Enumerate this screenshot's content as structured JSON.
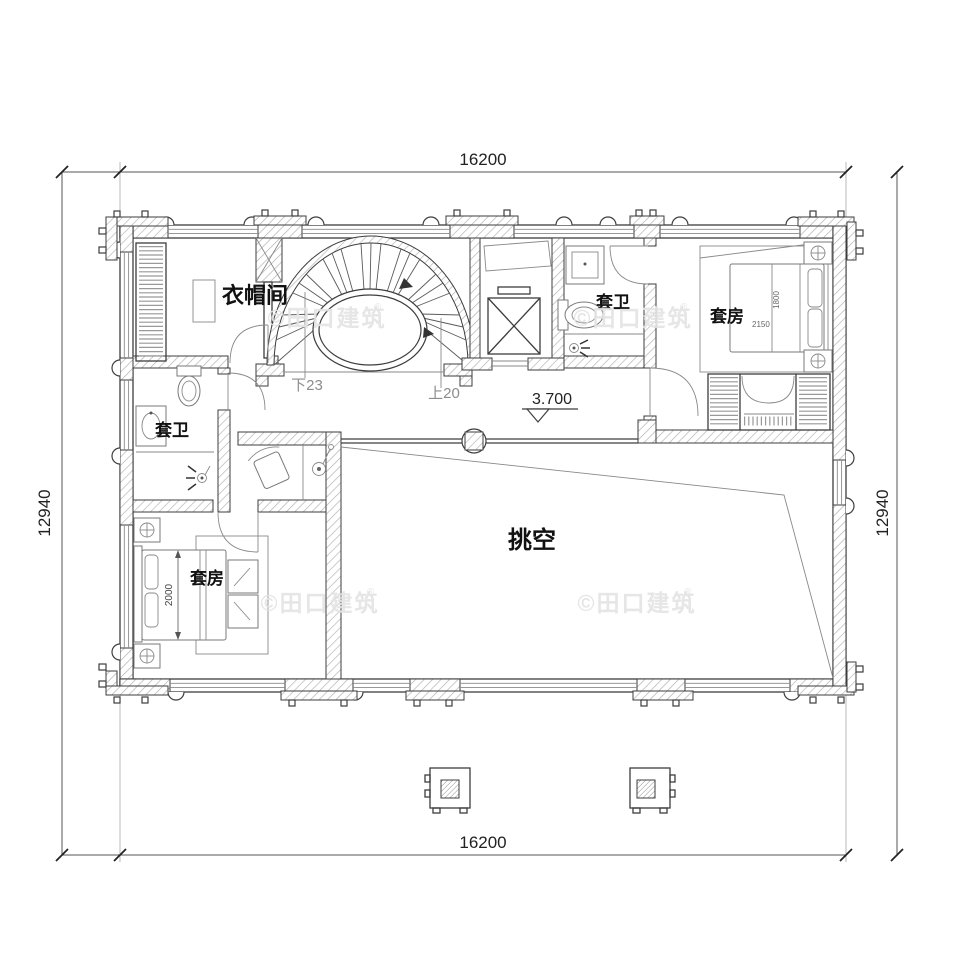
{
  "dimensions": {
    "top": "16200",
    "bottom": "16200",
    "left": "12940",
    "right": "12940",
    "bed_left": "2000",
    "bed_right_width": "1800",
    "bed_right_length": "2150"
  },
  "rooms": {
    "cloakroom": "衣帽间",
    "bath_top": "套卫",
    "bath_left": "套卫",
    "suite_right": "套房",
    "suite_left": "套房",
    "void": "挑空"
  },
  "stairs": {
    "down": "下23",
    "up": "上20"
  },
  "elevation": {
    "value": "3.700"
  },
  "watermark": {
    "text": "©田口建筑",
    "reg": "®"
  },
  "colors": {
    "line": "#3d3d3d",
    "muted": "#8c8c8c",
    "hatch": "#b0b0b0",
    "watermark": "#e3e3e3",
    "background": "#ffffff"
  }
}
